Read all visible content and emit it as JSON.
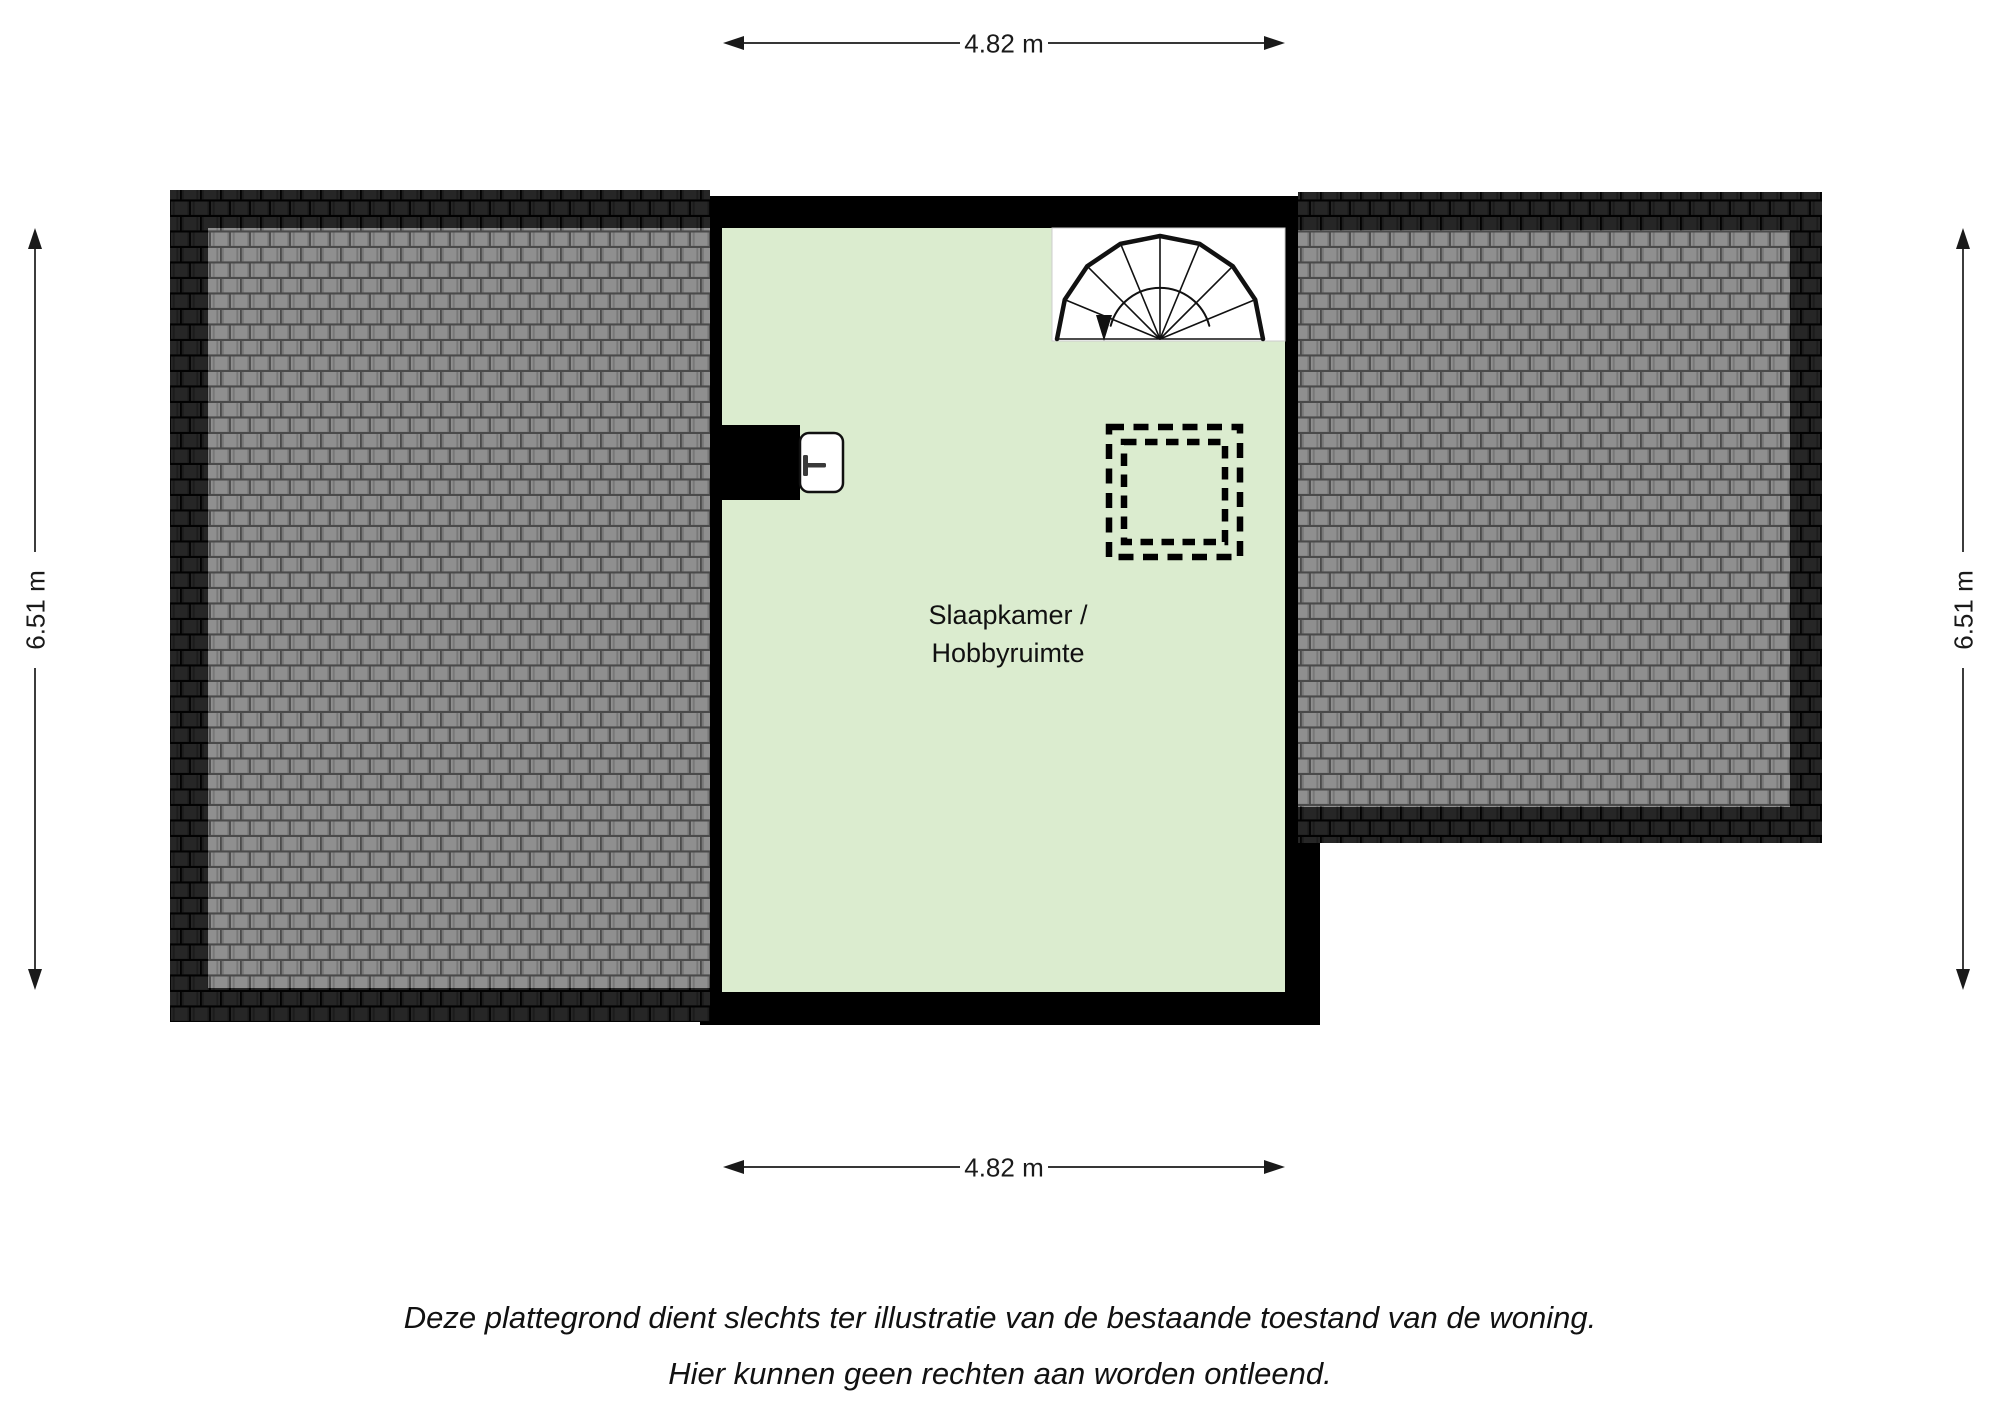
{
  "title": "Plattegrond verdieping",
  "room": {
    "name_line1": "Slaapkamer /",
    "name_line2": "Hobbyruimte"
  },
  "dimensions": {
    "top": "4.82 m",
    "bottom": "4.82 m",
    "left": "6.51 m",
    "right": "6.51 m"
  },
  "disclaimer": {
    "line1": "Deze plattegrond dient slechts ter illustratie van de bestaande toestand van de woning.",
    "line2": "Hier kunnen geen rechten aan worden ontleend."
  },
  "icons": {
    "spiral_stairs": "spiral-stairs-icon",
    "door": "door-icon",
    "roof_opening": "dashed-roof-opening-icon"
  },
  "colors": {
    "floor_green": "#dbeccf",
    "wall_black": "#000000",
    "roof_tile_light": "#8f8f8f",
    "roof_tile_dark": "#262626",
    "roof_seam_light": "#4a4a4a",
    "roof_seam_dark": "#020202",
    "dimension_line": "#1a1a1a"
  }
}
